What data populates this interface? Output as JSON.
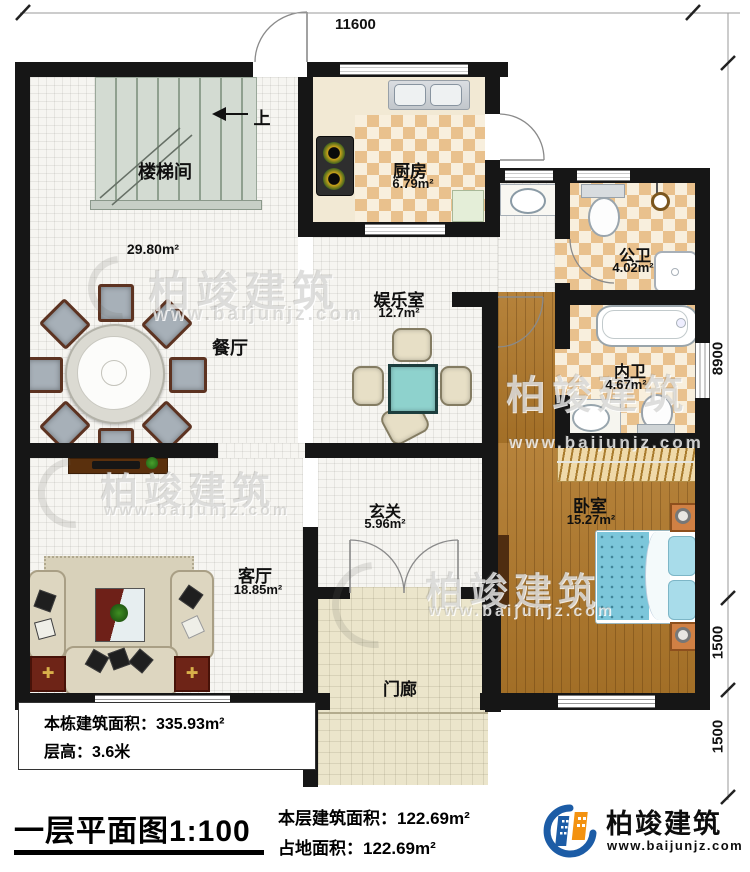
{
  "dims": {
    "top": "11600",
    "right": [
      "8900",
      "1500",
      "1500"
    ]
  },
  "rooms": [
    {
      "name": "楼梯间",
      "area": "29.80m²"
    },
    {
      "name": "餐厅",
      "area": ""
    },
    {
      "name": "厨房",
      "area": "6.79m²"
    },
    {
      "name": "娱乐室",
      "area": "12.7m²"
    },
    {
      "name": "公卫",
      "area": "4.02m²"
    },
    {
      "name": "内卫",
      "area": "4.67m²"
    },
    {
      "name": "玄关",
      "area": "5.96m²"
    },
    {
      "name": "卧室",
      "area": "15.27m²"
    },
    {
      "name": "客厅",
      "area": "18.85m²"
    },
    {
      "name": "门廊",
      "area": ""
    }
  ],
  "stairs": {
    "up_label": "上"
  },
  "info_box": {
    "line1": "本栋建筑面积：335.93m²",
    "line2": "层高：3.6米"
  },
  "title_block": {
    "title": "一层平面图1:100"
  },
  "areas": {
    "line1": "本层建筑面积：122.69m²",
    "line2": "占地面积：122.69m²"
  },
  "logo": {
    "name": "柏竣建筑",
    "url": "www.baijunjz.com"
  },
  "watermark": {
    "name": "柏竣建筑",
    "url": "www.baijunjz.com"
  },
  "colors": {
    "wall": "#161616",
    "wood": "#b0782a",
    "checker": "#e9c18d",
    "logo_blue": "#1c5ca6",
    "logo_orange": "#f39210",
    "bed_blue": "#7cc6da"
  }
}
